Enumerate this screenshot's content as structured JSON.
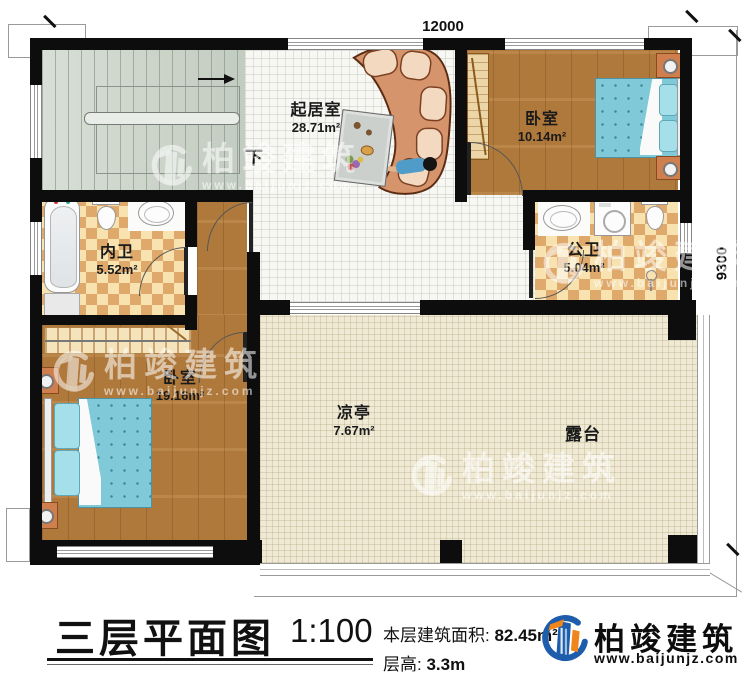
{
  "plan": {
    "dims": {
      "width_mm": "12000",
      "height_mm": "9300"
    },
    "down_label": "下",
    "rooms": {
      "living": {
        "name": "起居室",
        "area": "28.71m²"
      },
      "bedroom1": {
        "name": "卧室",
        "area": "10.14m²"
      },
      "ensuite": {
        "name": "内卫",
        "area": "5.52m²"
      },
      "publicbath": {
        "name": "公卫",
        "area": "5.04m²"
      },
      "bedroom2": {
        "name": "卧室",
        "area": "19.16m²"
      },
      "pavilion": {
        "name": "凉亭",
        "area": "7.67m²"
      },
      "terrace": {
        "name": "露台"
      }
    },
    "watermark": {
      "brand": "柏竣建筑",
      "url": "www.baijunjz.com"
    }
  },
  "titleblock": {
    "title": "三层平面图",
    "scale": "1:100",
    "area_label": "本层建筑面积:",
    "area_value": "82.45m²",
    "height_label": "层高:",
    "height_value": "3.3m",
    "brand": "柏竣建筑",
    "brand_url": "www.baijunjz.com"
  },
  "colors": {
    "wall": "#0d0d0d",
    "wood": "#b0793c",
    "checker_dark": "#dfa96b",
    "checker_light": "#f7e2b0",
    "stair": "#ccd4ca",
    "terrace": "#f0ead5",
    "bed": "#7fc9d8",
    "accent_blue": "#1d5dab",
    "accent_orange": "#f08519"
  }
}
